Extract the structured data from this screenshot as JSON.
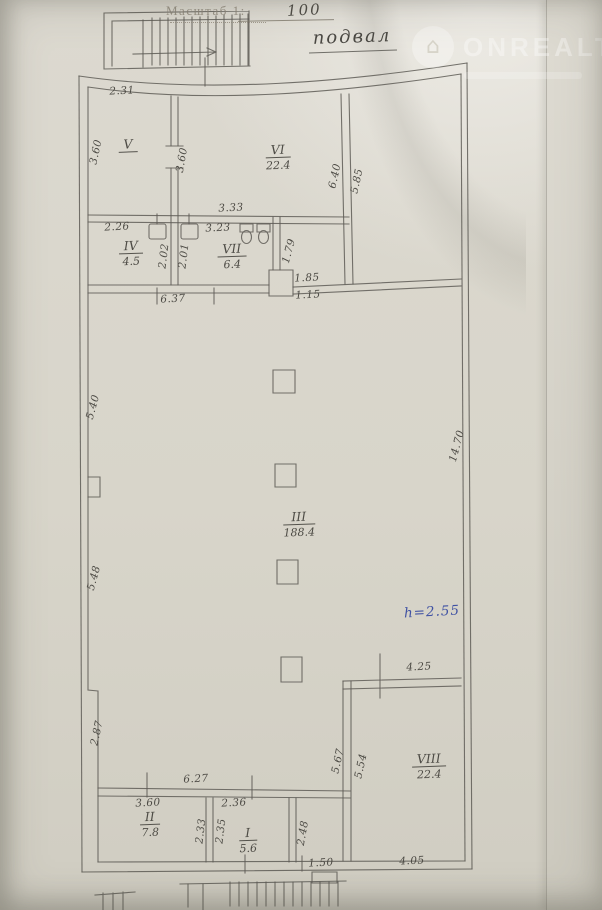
{
  "header": {
    "scale_label": "Масштаб 1:",
    "scale_value": "100",
    "plan_title": "подвал"
  },
  "watermark": {
    "brand": "ONREALT",
    "logo_icon": "house-in-circle"
  },
  "annotation": {
    "ceiling_height": "h=2.55"
  },
  "rooms": [
    {
      "number": "V",
      "area": ""
    },
    {
      "number": "VI",
      "area": "22.4"
    },
    {
      "number": "IV",
      "area": "4.5"
    },
    {
      "number": "VII",
      "area": "6.4"
    },
    {
      "number": "III",
      "area": "188.4"
    },
    {
      "number": "VIII",
      "area": "22.4"
    },
    {
      "number": "II",
      "area": "7.8"
    },
    {
      "number": "I",
      "area": "5.6"
    }
  ],
  "dimensions": {
    "v_top": "2.31",
    "v_left": "3.60",
    "v_wall": "3.60",
    "vi_bottom": "3.33",
    "iv_top": "2.26",
    "vii_top": "3.23",
    "wall_left": "2.02",
    "wall_right": "2.01",
    "vii_right": "1.79",
    "vi_right_inner": "6.40",
    "vi_right_outer": "5.85",
    "opening_top": "1.85",
    "opening_bottom": "1.15",
    "strip_bottom": "6.37",
    "left_upper": "5.40",
    "left_mid": "5.48",
    "right_wall": "14.70",
    "left_lower": "2.87",
    "lower_top": "6.27",
    "ii_top": "3.60",
    "i_top": "2.36",
    "ii_wall": "2.33",
    "i_wall": "2.35",
    "i_right": "2.48",
    "bottom_gap": "1.50",
    "viii_bottom": "4.05",
    "viii_top": "4.25",
    "viii_left_outer": "5.67",
    "viii_left_inner": "5.54"
  }
}
